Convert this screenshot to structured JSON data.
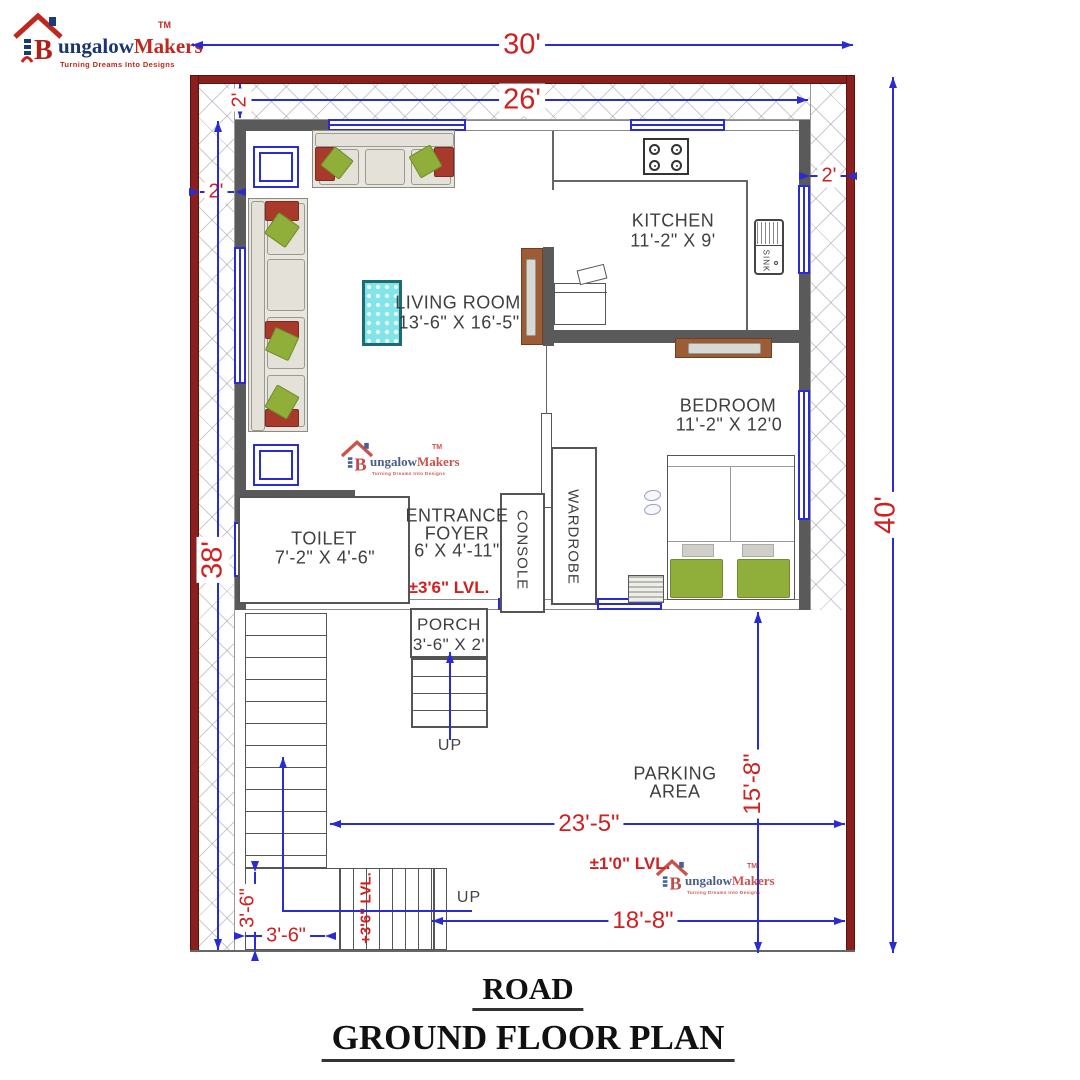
{
  "brand": {
    "initial": "B",
    "name_blue": "ungalow",
    "name_red": "Makers",
    "tagline": "Turning Dreams Into Designs",
    "tm": "TM"
  },
  "rooms": {
    "living": {
      "name": "LIVING ROOM",
      "size": "13'-6\" X 16'-5\""
    },
    "kitchen": {
      "name": "KITCHEN",
      "size": "11'-2\" X 9'"
    },
    "bedroom": {
      "name": "BEDROOM",
      "size": "11'-2\" X 12'0"
    },
    "toilet": {
      "name": "TOILET",
      "size": "7'-2\" X 4'-6\""
    },
    "foyer": {
      "line1": "ENTRANCE",
      "line2": "FOYER",
      "size": "6' X 4'-11\""
    },
    "porch": {
      "name": "PORCH",
      "size": "3'-6\" X 2'"
    },
    "parking": {
      "line1": "PARKING",
      "line2": "AREA"
    },
    "console": "CONSOLE",
    "wardrobe": "WARDROBE",
    "sink": "SINK"
  },
  "levels": {
    "foyer": "±3'6\" LVL.",
    "parking": "±1'0\" LVL.",
    "stair": "+3'6\" LVL."
  },
  "dims": {
    "total_width": "30'",
    "inner_width": "26'",
    "total_height": "40'",
    "left_height": "38'",
    "setback_top": "2'",
    "setback_left": "2'",
    "setback_right": "2'",
    "parking_width": "23'-5\"",
    "parking_height": "15'-8\"",
    "drive_width": "18'-8\"",
    "stair_width_v": "3'-6\"",
    "stair_width_h": "3'-6\""
  },
  "stairs": {
    "porch_up": "UP",
    "outer_up": "UP"
  },
  "titles": {
    "road": "ROAD",
    "plan": "GROUND FLOOR PLAN"
  },
  "colors": {
    "boundary": "#8a201d",
    "wall": "#5a5a5a",
    "blue": "#2b2bd2",
    "red": "#d02020",
    "green": "#8fae3a",
    "wood": "#9c5c35",
    "teal": "#82e4e8",
    "accent": "#a83a2c"
  }
}
